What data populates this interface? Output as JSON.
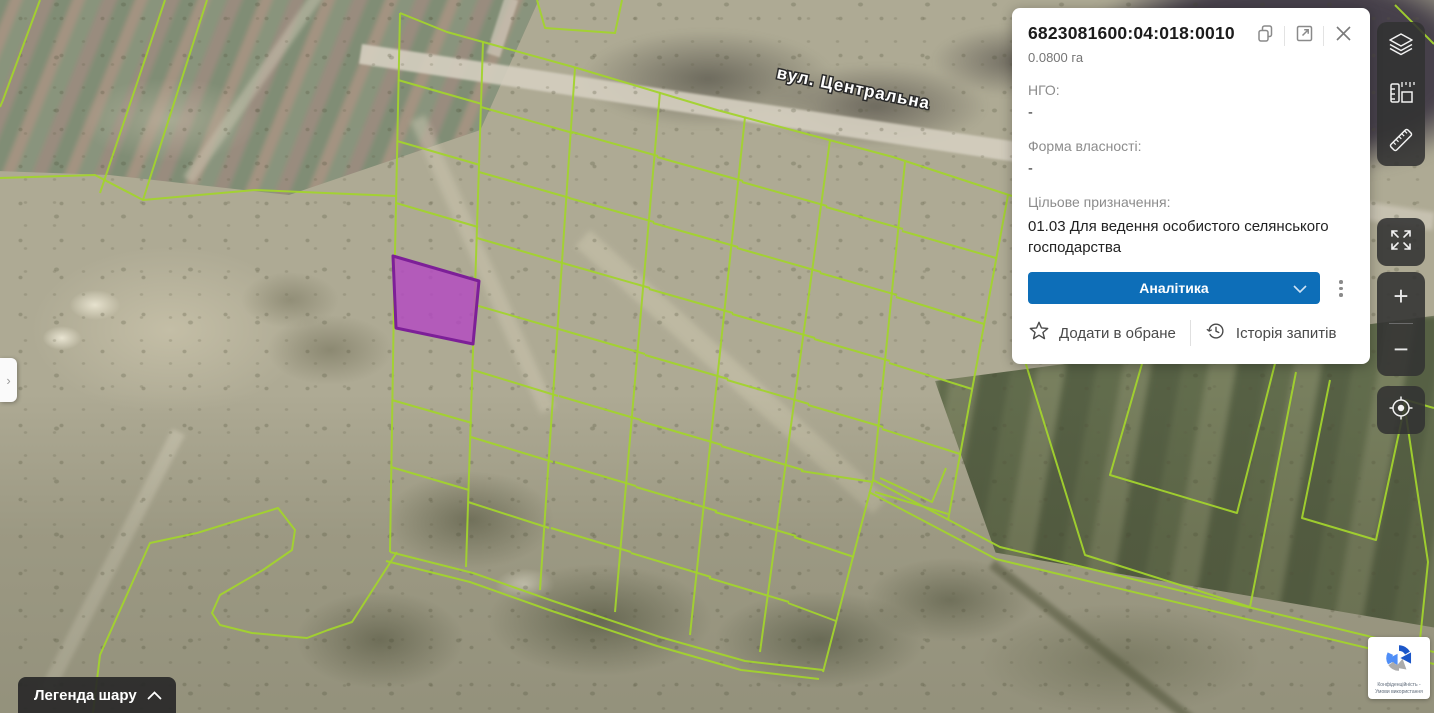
{
  "panel": {
    "parcel_id": "6823081600:04:018:0010",
    "area": "0.0800 га",
    "fields": [
      {
        "label": "НГО:",
        "value": "-"
      },
      {
        "label": "Форма власності:",
        "value": "-"
      },
      {
        "label": "Цільове призначення:",
        "value": "01.03 Для ведення особистого селянського господарства"
      }
    ],
    "analytics_button": "Аналітика",
    "favorites_label": "Додати в обране",
    "history_label": "Історія запитів"
  },
  "map": {
    "street_label": "вул. Центральна",
    "parcel_line_color": "#a2d32d",
    "selected_parcel_fill": "#b545c5",
    "selected_parcel_stroke": "#7d1f98"
  },
  "toolbar": {
    "zoom_in_symbol": "+",
    "zoom_out_symbol": "−"
  },
  "legend_button": "Легенда шару",
  "left_tab_symbol": "›",
  "recaptcha_text": "Конфіденційність - Умови використання",
  "accent_blue": "#0d6eb8"
}
